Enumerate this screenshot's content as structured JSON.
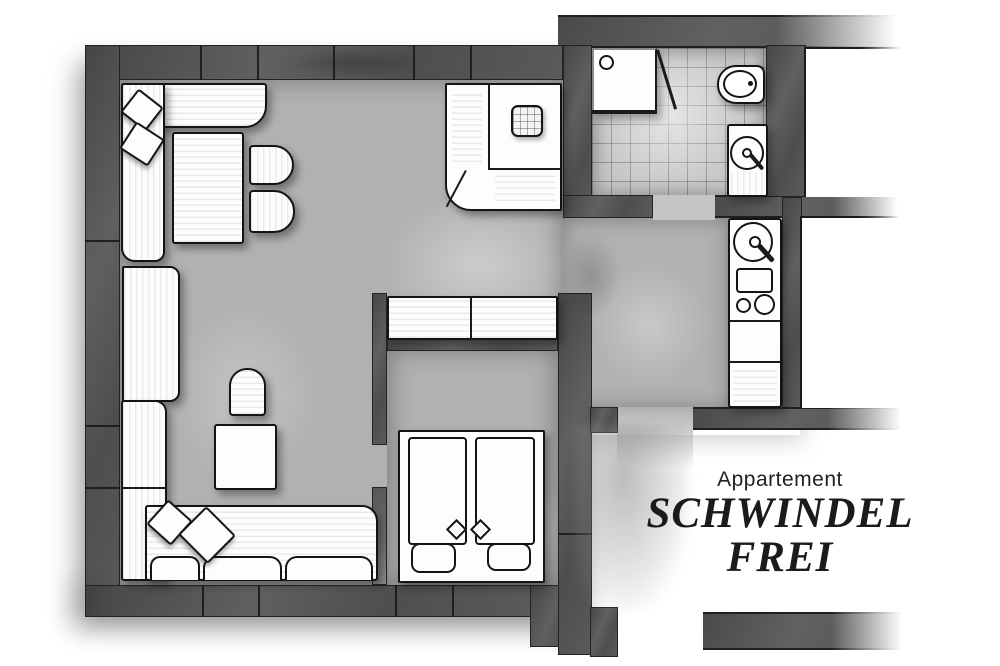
{
  "meta": {
    "type": "floor-plan",
    "style": "hand-drawn grayscale architectural sketch"
  },
  "title": {
    "brand": "Appartement",
    "name_line1": "SCHWINDEL",
    "name_line2": "FREI"
  },
  "palette": {
    "page": "#ffffff",
    "wall": "#525252",
    "wall_edge": "#232323",
    "floor": "#b1b1b1",
    "tile_floor": "#c7c7c7",
    "furniture_fill": "#fdfdfd",
    "furniture_outline": "#141414",
    "text": "#1d1d1d"
  },
  "rooms": [
    "living-room",
    "kitchenette",
    "bathroom",
    "bedroom",
    "hallway",
    "entry"
  ],
  "furniture": [
    "corner-sofa-top",
    "throw-cushions",
    "dining-table",
    "dining-chairs",
    "sideboard",
    "armchair",
    "side-table",
    "corner-sofa-bottom",
    "kitchen-corner-counter-with-sink",
    "kitchen-unit-sink-stove-burners",
    "wardrobe",
    "double-bed-with-pillows",
    "shower",
    "toilet",
    "washbasin"
  ]
}
